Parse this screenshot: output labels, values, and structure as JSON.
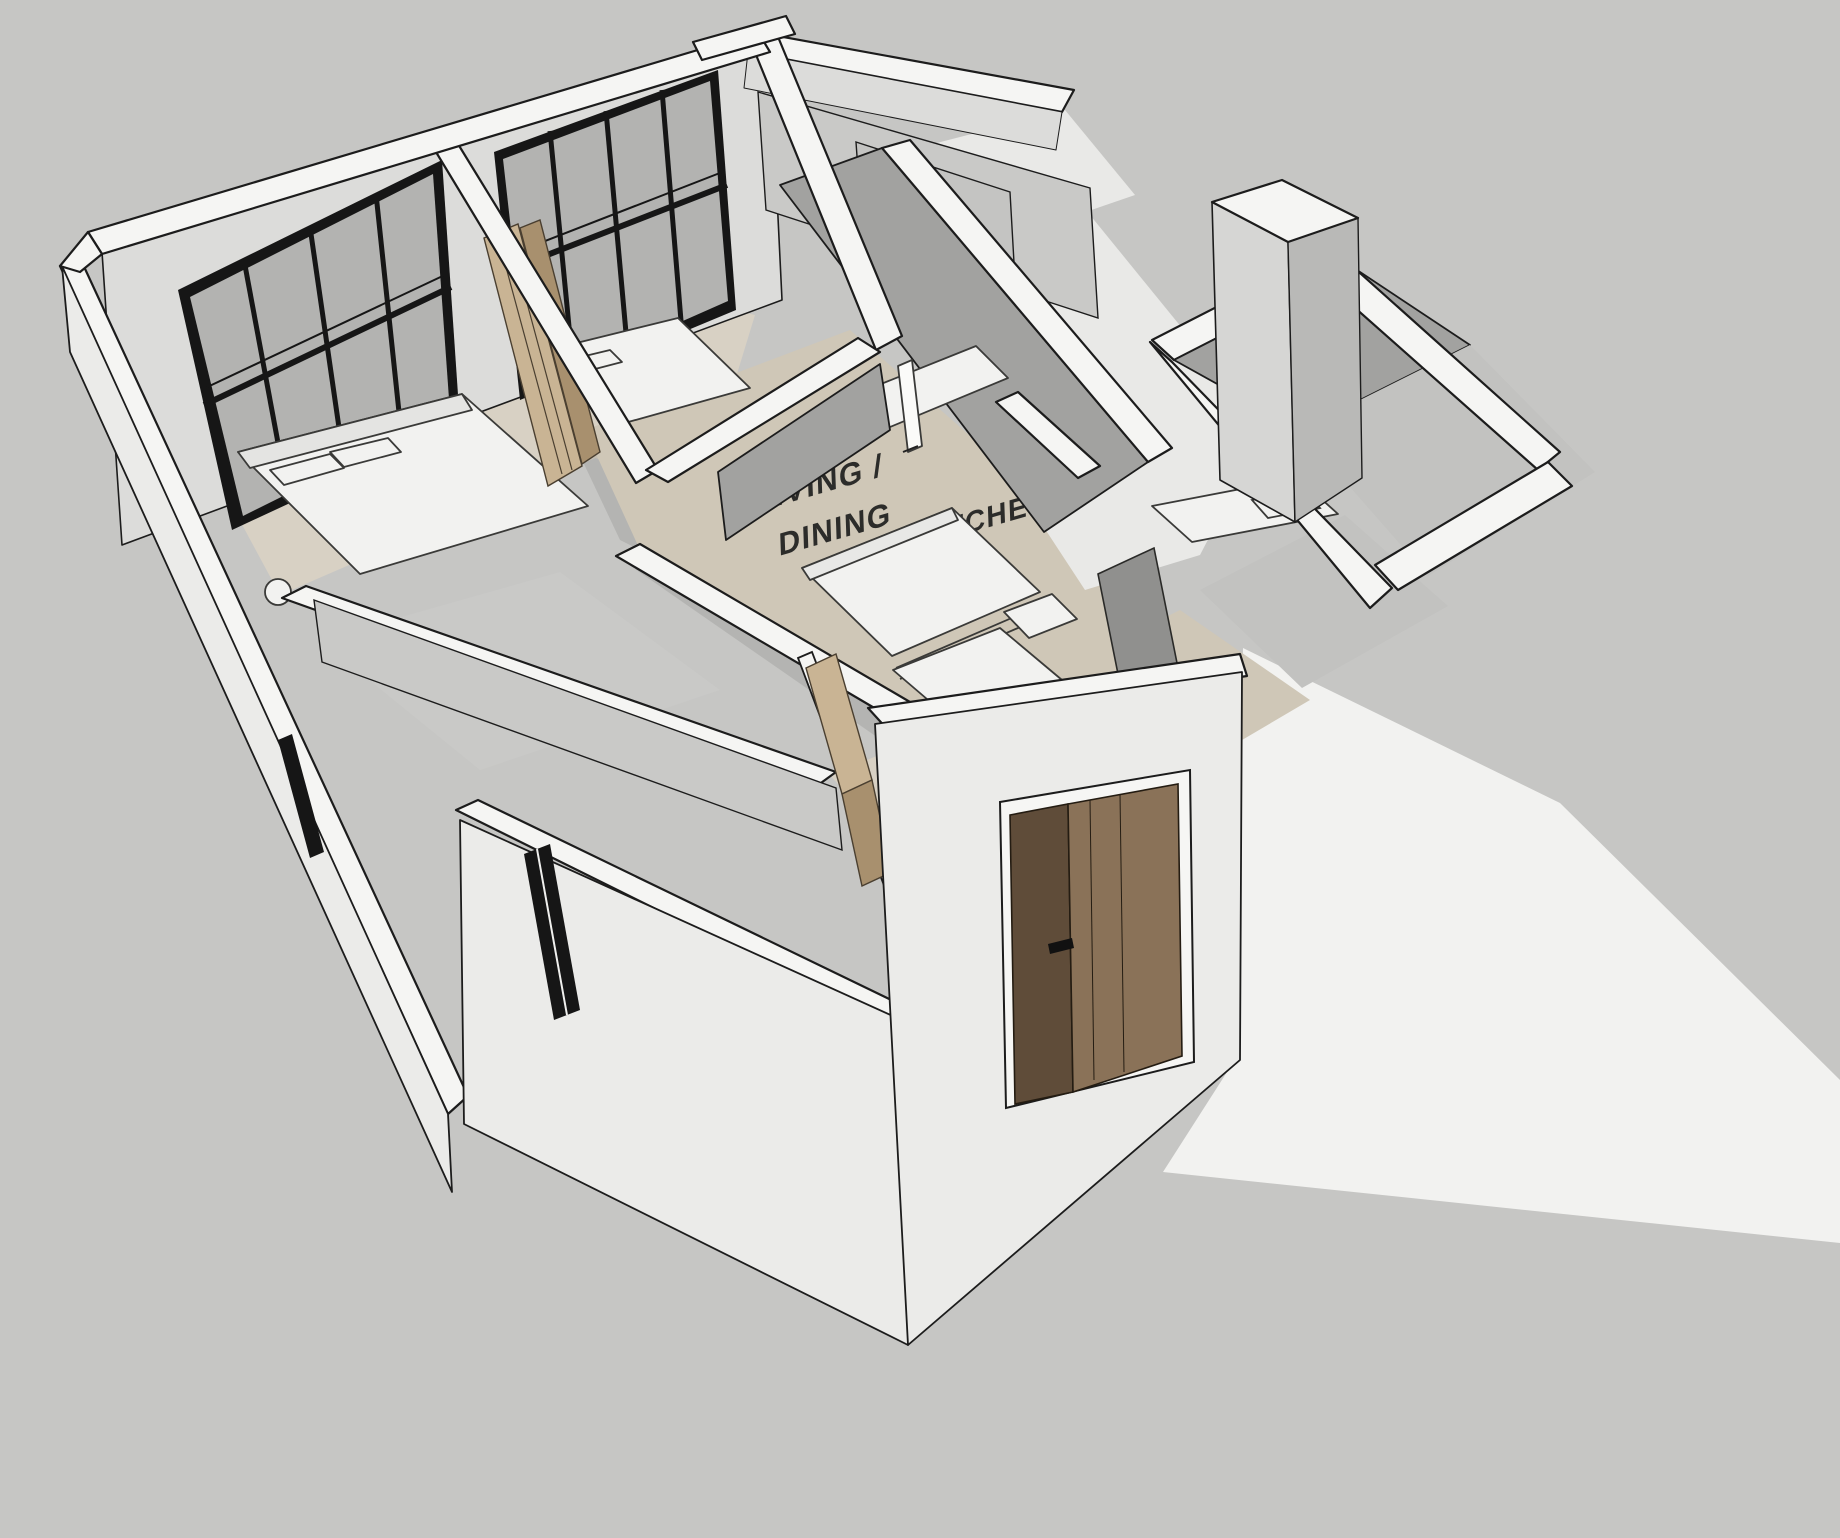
{
  "scene": {
    "kind": "3d-floorplan-cutaway-render",
    "description": "Axonometric SketchUp-style dollhouse view of a small apartment unit seen from above-front, white walls with black edge lines on a plain gray background"
  },
  "labels": {
    "living_dining_line1": "LIVING /",
    "living_dining_line2": "DINING",
    "kitchen": "KITCHEN"
  },
  "palette": {
    "bg": "#c6c6c4",
    "ground": "#f2f2f0",
    "wallTop": "#f5f5f3",
    "faceLight": "#dcdcda",
    "faceExt": "#ebebe9",
    "faceMed": "#c9c9c7",
    "faceDark": "#a2a2a0",
    "floorBeige": "#cfc7b7",
    "floorBedroom": "#d8d1c4",
    "floorLight": "#e9e9e7",
    "floorGray": "#c2c2c0",
    "glass": "#b3b3b1",
    "windowFrame": "#161616",
    "furniture": "#f2f2f0",
    "woodLight": "#c9b494",
    "woodMid": "#a8906e",
    "doorDark": "#5f4c39",
    "doorLight": "#8a7258",
    "label": "#2c2c2a",
    "line": "#1c1c1c"
  }
}
